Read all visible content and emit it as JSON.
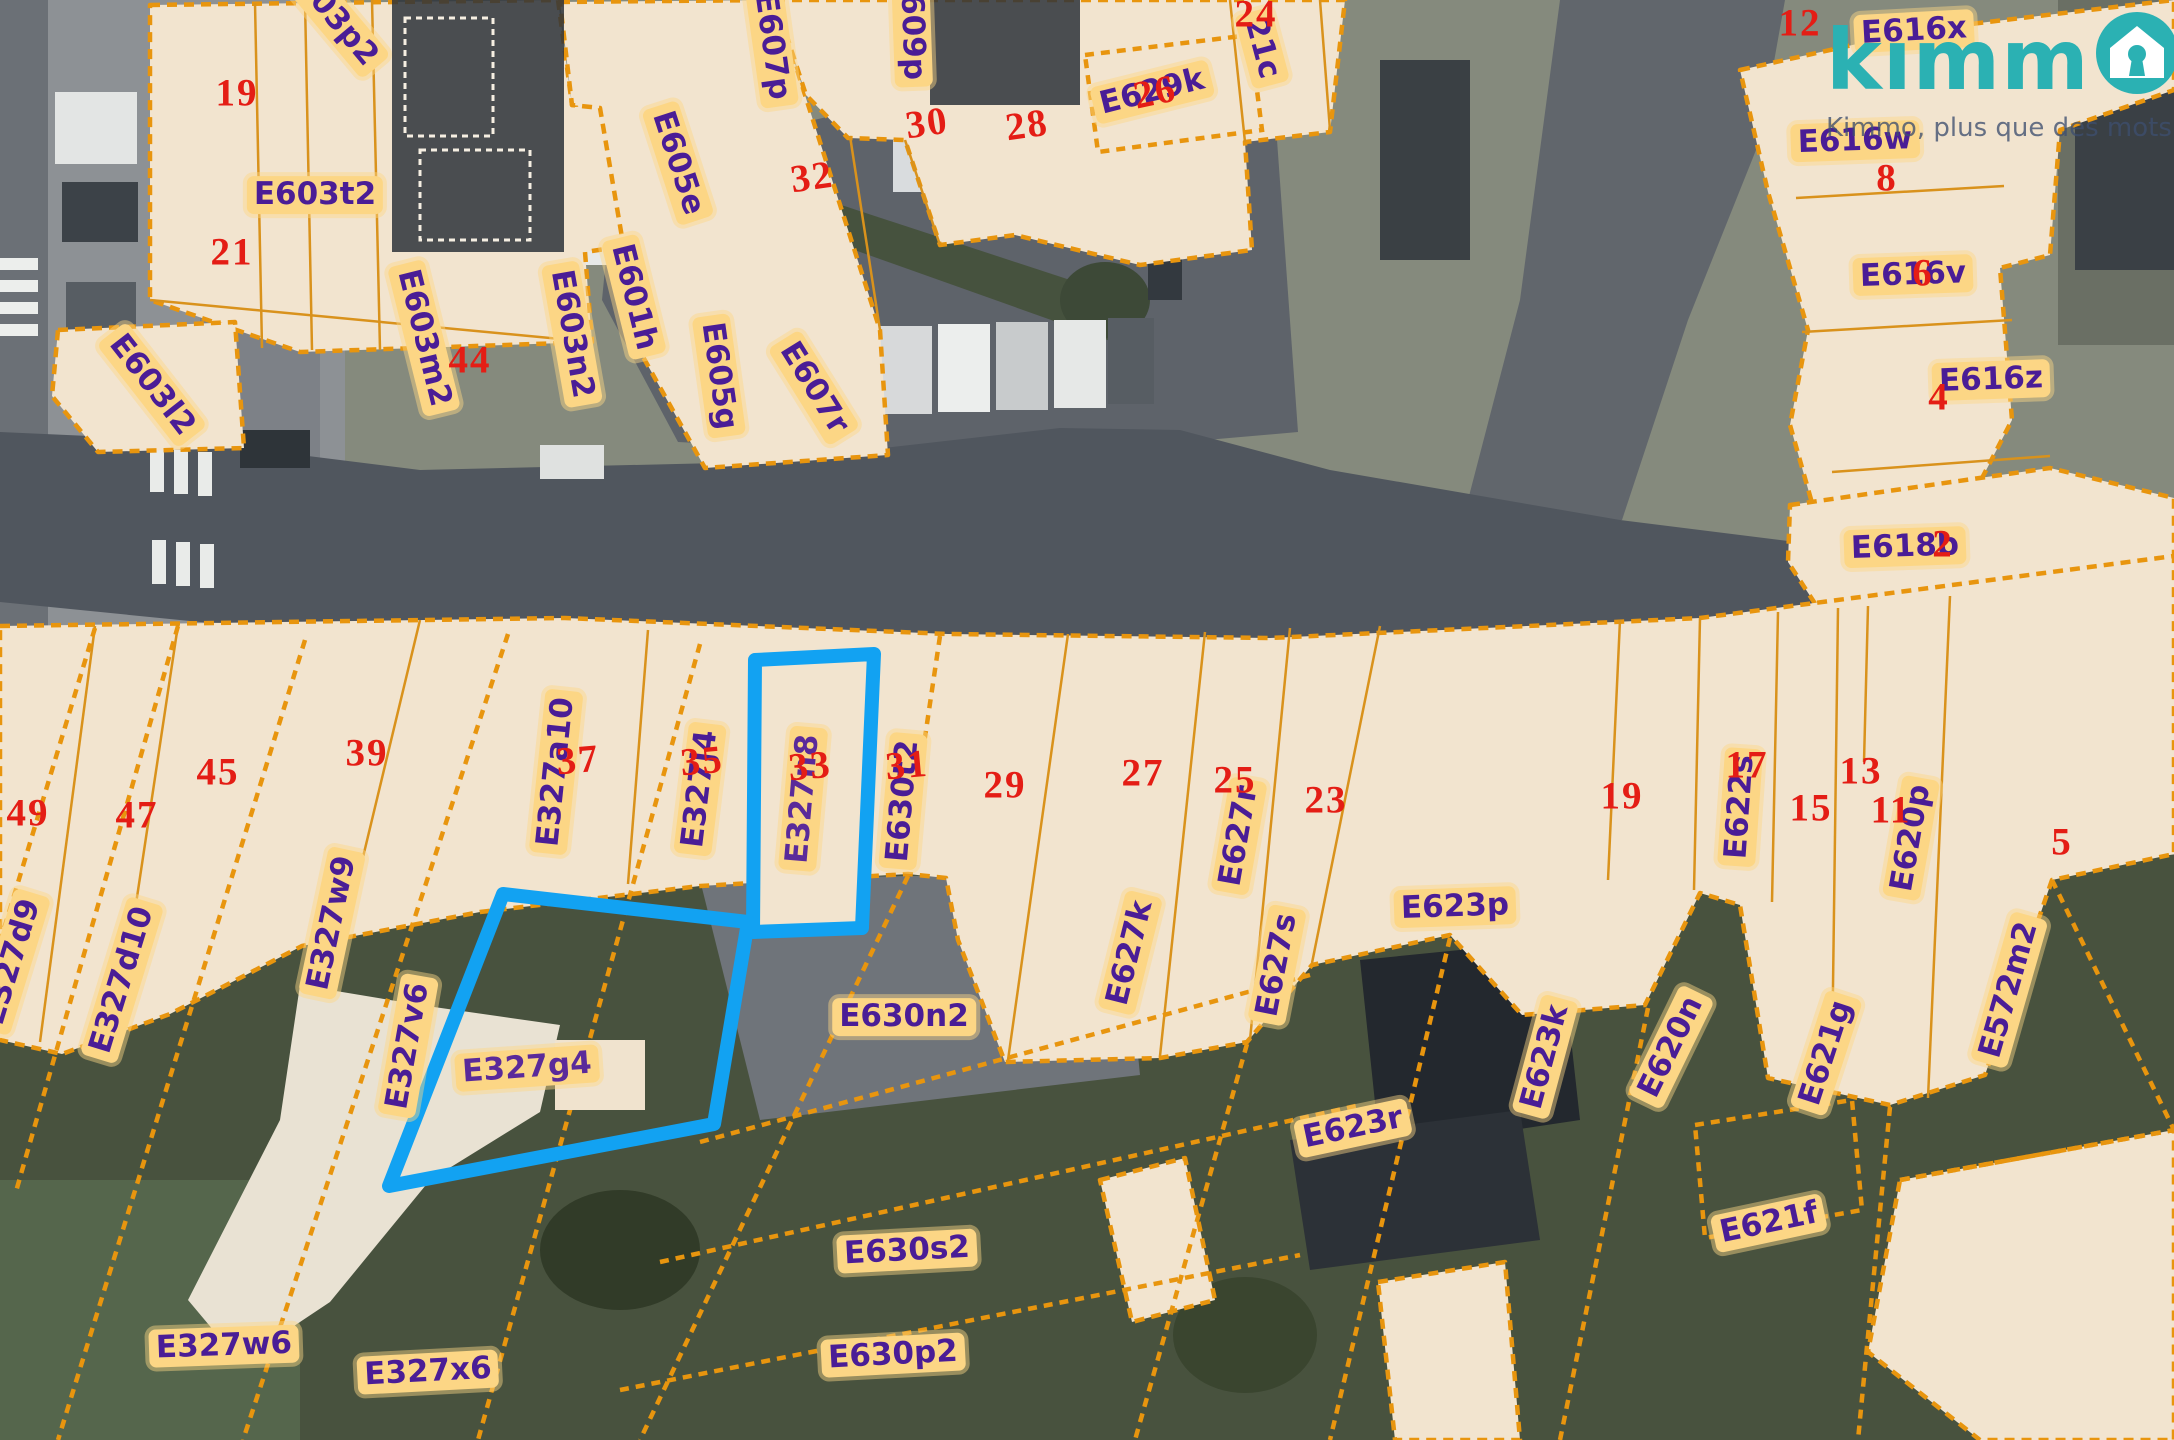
{
  "app": {
    "logo_text_partial": "kımm",
    "logo_full_name": "kimmo",
    "logo_tagline": "Kimmo, plus que des mots !",
    "brand_color": "#2bb1b3",
    "tagline_color": "#3e4e6e"
  },
  "map": {
    "type": "cadastral-parcel-overlay-on-aerial-photo",
    "colors": {
      "parcel_fill": "#f2e4cf",
      "parcel_border": "#e8950e",
      "label_background": "#fcd685",
      "label_text": "#4a1d96",
      "street_number_text": "#e41d15",
      "highlight": "#12a2f2"
    },
    "highlighted_parcels": [
      "E327n8",
      "E327g4"
    ],
    "parcel_labels": [
      {
        "t": "E603p2",
        "x": 330,
        "y": 12,
        "r": 50
      },
      {
        "t": "E603t2",
        "x": 315,
        "y": 195,
        "r": 0
      },
      {
        "t": "E603l2",
        "x": 152,
        "y": 385,
        "r": 52
      },
      {
        "t": "E603m2",
        "x": 424,
        "y": 338,
        "r": 76
      },
      {
        "t": "E603n2",
        "x": 572,
        "y": 334,
        "r": 80
      },
      {
        "t": "E601h",
        "x": 634,
        "y": 297,
        "r": 76
      },
      {
        "t": "E605e",
        "x": 678,
        "y": 163,
        "r": 72
      },
      {
        "t": "E605g",
        "x": 719,
        "y": 376,
        "r": 82
      },
      {
        "t": "E607r",
        "x": 814,
        "y": 388,
        "r": 58
      },
      {
        "t": "E607p",
        "x": 772,
        "y": 46,
        "r": 82
      },
      {
        "t": "E609p",
        "x": 912,
        "y": 26,
        "r": 88
      },
      {
        "t": "E629k",
        "x": 1152,
        "y": 92,
        "r": -14
      },
      {
        "t": "21c",
        "x": 1262,
        "y": 48,
        "r": 75
      },
      {
        "t": "E616x",
        "x": 1914,
        "y": 31,
        "r": -3
      },
      {
        "t": "E616w",
        "x": 1855,
        "y": 141,
        "r": -2
      },
      {
        "t": "E616v",
        "x": 1913,
        "y": 275,
        "r": -2
      },
      {
        "t": "E616z",
        "x": 1991,
        "y": 380,
        "r": -2
      },
      {
        "t": "E618b",
        "x": 1905,
        "y": 547,
        "r": -2
      },
      {
        "t": "E327d9",
        "x": 12,
        "y": 962,
        "r": -73
      },
      {
        "t": "E327d10",
        "x": 122,
        "y": 980,
        "r": -73
      },
      {
        "t": "E327w9",
        "x": 332,
        "y": 923,
        "r": -78
      },
      {
        "t": "E327v6",
        "x": 408,
        "y": 1046,
        "r": -80
      },
      {
        "t": "E327a10",
        "x": 556,
        "y": 772,
        "r": -84
      },
      {
        "t": "E327j4",
        "x": 700,
        "y": 789,
        "r": -83
      },
      {
        "t": "E327n8",
        "x": 803,
        "y": 799,
        "r": -85
      },
      {
        "t": "E630t2",
        "x": 903,
        "y": 801,
        "r": -85
      },
      {
        "t": "E630n2",
        "x": 904,
        "y": 1017,
        "r": 0
      },
      {
        "t": "E627k",
        "x": 1130,
        "y": 953,
        "r": -76
      },
      {
        "t": "E627r",
        "x": 1239,
        "y": 836,
        "r": -80
      },
      {
        "t": "E627s",
        "x": 1277,
        "y": 965,
        "r": -79
      },
      {
        "t": "E623p",
        "x": 1455,
        "y": 907,
        "r": -2
      },
      {
        "t": "E622s",
        "x": 1740,
        "y": 807,
        "r": -86
      },
      {
        "t": "E620p",
        "x": 1911,
        "y": 838,
        "r": -80
      },
      {
        "t": "E572m2",
        "x": 2009,
        "y": 990,
        "r": -74
      },
      {
        "t": "E623k",
        "x": 1545,
        "y": 1057,
        "r": -75
      },
      {
        "t": "E620n",
        "x": 1671,
        "y": 1047,
        "r": -64
      },
      {
        "t": "E621g",
        "x": 1826,
        "y": 1053,
        "r": -72
      },
      {
        "t": "E623r",
        "x": 1353,
        "y": 1128,
        "r": -12
      },
      {
        "t": "E621f",
        "x": 1769,
        "y": 1223,
        "r": -12
      },
      {
        "t": "E630s2",
        "x": 907,
        "y": 1251,
        "r": -3
      },
      {
        "t": "E630p2",
        "x": 893,
        "y": 1355,
        "r": -3
      },
      {
        "t": "E327w6",
        "x": 224,
        "y": 1346,
        "r": -2
      },
      {
        "t": "E327x6",
        "x": 428,
        "y": 1372,
        "r": -3
      },
      {
        "t": "E327g4",
        "x": 527,
        "y": 1068,
        "r": -4
      }
    ],
    "street_numbers": [
      {
        "t": "19",
        "x": 237,
        "y": 93,
        "r": 0
      },
      {
        "t": "21",
        "x": 232,
        "y": 252,
        "r": 0
      },
      {
        "t": "44",
        "x": 470,
        "y": 360,
        "r": 0
      },
      {
        "t": "32",
        "x": 812,
        "y": 177,
        "r": -8
      },
      {
        "t": "30",
        "x": 927,
        "y": 123,
        "r": -8
      },
      {
        "t": "28",
        "x": 1027,
        "y": 125,
        "r": -8
      },
      {
        "t": "26",
        "x": 1155,
        "y": 92,
        "r": -12
      },
      {
        "t": "24",
        "x": 1256,
        "y": 14,
        "r": 0
      },
      {
        "t": "12",
        "x": 1800,
        "y": 23,
        "r": 0
      },
      {
        "t": "8",
        "x": 1887,
        "y": 178,
        "r": 0
      },
      {
        "t": "6",
        "x": 1923,
        "y": 273,
        "r": 0
      },
      {
        "t": "4",
        "x": 1939,
        "y": 397,
        "r": 0
      },
      {
        "t": "2",
        "x": 1943,
        "y": 544,
        "r": 0
      },
      {
        "t": "49",
        "x": 28,
        "y": 813,
        "r": 0
      },
      {
        "t": "47",
        "x": 137,
        "y": 815,
        "r": 0
      },
      {
        "t": "45",
        "x": 218,
        "y": 772,
        "r": 0
      },
      {
        "t": "39",
        "x": 367,
        "y": 753,
        "r": 0
      },
      {
        "t": "37",
        "x": 578,
        "y": 760,
        "r": -5
      },
      {
        "t": "35",
        "x": 702,
        "y": 761,
        "r": -5
      },
      {
        "t": "33",
        "x": 810,
        "y": 766,
        "r": -5
      },
      {
        "t": "31",
        "x": 907,
        "y": 765,
        "r": -5
      },
      {
        "t": "29",
        "x": 1005,
        "y": 785,
        "r": 0
      },
      {
        "t": "27",
        "x": 1143,
        "y": 773,
        "r": 0
      },
      {
        "t": "25",
        "x": 1235,
        "y": 780,
        "r": 0
      },
      {
        "t": "23",
        "x": 1326,
        "y": 800,
        "r": 0
      },
      {
        "t": "19",
        "x": 1622,
        "y": 796,
        "r": 0
      },
      {
        "t": "17",
        "x": 1747,
        "y": 765,
        "r": 0
      },
      {
        "t": "15",
        "x": 1811,
        "y": 808,
        "r": 0
      },
      {
        "t": "13",
        "x": 1861,
        "y": 771,
        "r": 0
      },
      {
        "t": "11",
        "x": 1891,
        "y": 810,
        "r": 0
      },
      {
        "t": "5",
        "x": 2062,
        "y": 842,
        "r": 0
      }
    ]
  }
}
